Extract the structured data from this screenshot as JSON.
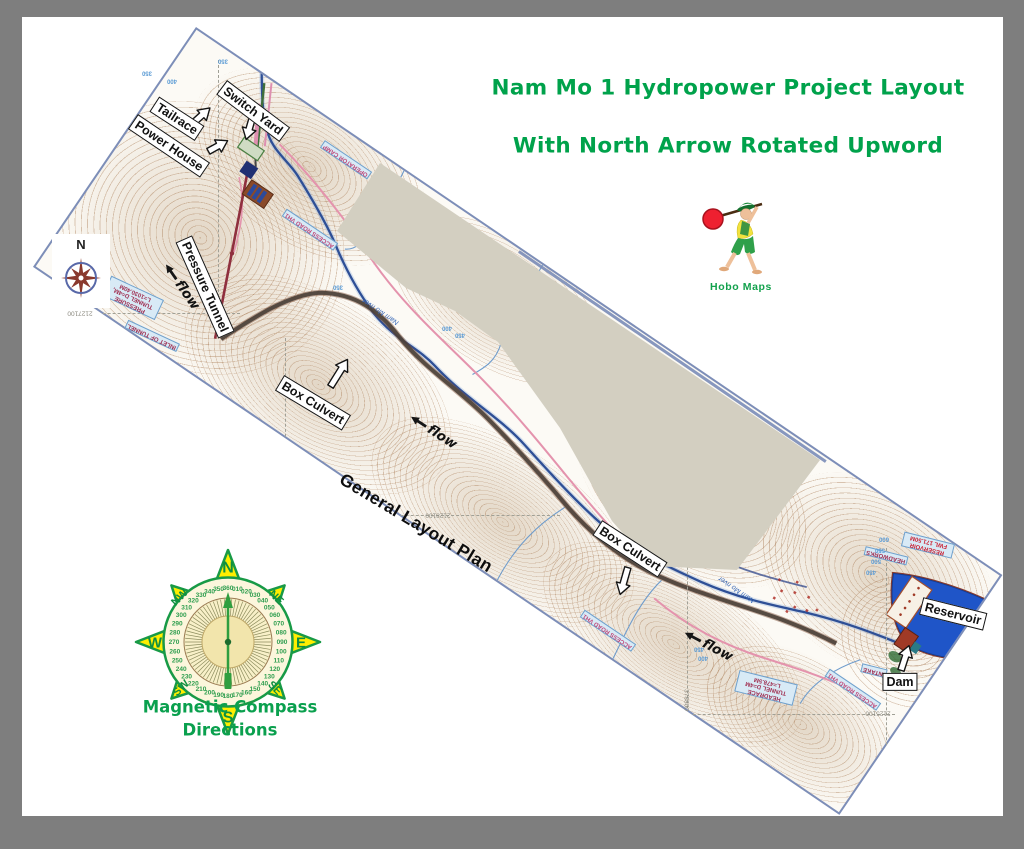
{
  "title": {
    "line1": "Nam Mo 1 Hydropower Project Layout",
    "line2": "With North Arrow Rotated Upword",
    "color": "#00a24b"
  },
  "logo": {
    "label": "Hobo Maps"
  },
  "plan_label": "General Layout Plan",
  "north_box": {
    "label": "N"
  },
  "compass": {
    "caption_line1": "Magnetic Compass",
    "caption_line2": "Directions",
    "degree_step": 10,
    "degree_count": 36,
    "tick_count": 72,
    "directions": [
      {
        "label": "N",
        "deg": 0,
        "r": 75,
        "size": 16,
        "rot": 0
      },
      {
        "label": "NE",
        "deg": 45,
        "r": 65,
        "size": 11,
        "rot": 45
      },
      {
        "label": "E",
        "deg": 90,
        "r": 73,
        "size": 15,
        "rot": 0
      },
      {
        "label": "SE",
        "deg": 135,
        "r": 63,
        "size": 11,
        "rot": 45
      },
      {
        "label": "S",
        "deg": 180,
        "r": 75,
        "size": 16,
        "rot": 0
      },
      {
        "label": "SW",
        "deg": 225,
        "r": 63,
        "size": 11,
        "rot": -45
      },
      {
        "label": "W",
        "deg": 270,
        "r": 73,
        "size": 15,
        "rot": 0
      },
      {
        "label": "NW",
        "deg": 315,
        "r": 65,
        "size": 11,
        "rot": -45
      }
    ],
    "colors": {
      "star": "#ffee00",
      "outline": "#189a46",
      "numbers": "#2f9e4f",
      "needle": "#2f9e3f",
      "face": "#fcf6dc",
      "inner": "#f2e5ac"
    }
  },
  "callouts": [
    {
      "label": "Switch Yard",
      "x": 253,
      "y": 111,
      "rot": 37
    },
    {
      "label": "Tailrace",
      "x": 177,
      "y": 119,
      "rot": 33
    },
    {
      "label": "Power House",
      "x": 169,
      "y": 146,
      "rot": 34
    },
    {
      "label": "Pressure Tunnel",
      "x": 205,
      "y": 287,
      "rot": 66
    },
    {
      "label": "Box Culvert",
      "x": 313,
      "y": 403,
      "rot": 31
    },
    {
      "label": "Box Culvert",
      "x": 630,
      "y": 549,
      "rot": 33
    },
    {
      "label": "Reservoir",
      "x": 953,
      "y": 614,
      "rot": 14
    },
    {
      "label": "Dam",
      "x": 900,
      "y": 682,
      "rot": 0
    }
  ],
  "flow_labels": [
    {
      "label": "flow",
      "x": 181,
      "y": 286,
      "rot": 55
    },
    {
      "label": "flow",
      "x": 433,
      "y": 431,
      "rot": 33
    },
    {
      "label": "flow",
      "x": 708,
      "y": 645,
      "rot": 28
    }
  ],
  "callout_arrows": [
    {
      "x": 201,
      "y": 116,
      "rot": 48,
      "len": 26
    },
    {
      "x": 218,
      "y": 146,
      "rot": 61,
      "len": 24
    },
    {
      "x": 250,
      "y": 126,
      "rot": 196,
      "len": 30
    },
    {
      "x": 339,
      "y": 373,
      "rot": 32,
      "len": 34
    },
    {
      "x": 624,
      "y": 581,
      "rot": 196,
      "len": 30
    },
    {
      "x": 905,
      "y": 658,
      "rot": 18,
      "len": 28
    }
  ],
  "map_texts": [
    {
      "text": "OPERATOR CAMP",
      "x": 346,
      "y": 160,
      "rot": 214,
      "cls": "mt-road"
    },
    {
      "text": "ACCESS ROAD VH1",
      "x": 310,
      "y": 230,
      "rot": 214,
      "cls": "mt-road"
    },
    {
      "text": "ACCESS ROAD VH1",
      "x": 608,
      "y": 631,
      "rot": 214,
      "cls": "mt-road"
    },
    {
      "text": "ACCESS ROAD VH1",
      "x": 853,
      "y": 690,
      "rot": 214,
      "cls": "mt-road"
    },
    {
      "text": "PRESSURE TUNNEL D=4M, L=1030.40M",
      "x": 133,
      "y": 298,
      "rot": 205,
      "cls": "mt-eng",
      "w": 54
    },
    {
      "text": "INLET OF TUNNEL",
      "x": 152,
      "y": 336,
      "rot": 205,
      "cls": "mt-eng"
    },
    {
      "text": "HEADRACE TUNNEL D=4M L=478.5M",
      "x": 766,
      "y": 688,
      "rot": 194,
      "cls": "mt-eng",
      "w": 56
    },
    {
      "text": "HEADWORKS",
      "x": 886,
      "y": 556,
      "rot": 194,
      "cls": "mt-eng"
    },
    {
      "text": "INTAKE",
      "x": 874,
      "y": 671,
      "rot": 194,
      "cls": "mt-eng"
    },
    {
      "text": "RESERVOIR FWL 171.50M",
      "x": 928,
      "y": 545,
      "rot": 194,
      "cls": "mt-res",
      "w": 48
    },
    {
      "text": "Nam Mo river",
      "x": 381,
      "y": 311,
      "rot": 214,
      "cls": "mt-river"
    },
    {
      "text": "Nam Mo river",
      "x": 737,
      "y": 589,
      "rot": 214,
      "cls": "mt-river"
    },
    {
      "text": "2127100",
      "x": 80,
      "y": 313,
      "rot": 180,
      "cls": "mt-grid"
    },
    {
      "text": "2128100",
      "x": 438,
      "y": 515,
      "rot": 180,
      "cls": "mt-grid"
    },
    {
      "text": "2125100",
      "x": 878,
      "y": 713,
      "rot": 180,
      "cls": "mt-grid"
    },
    {
      "text": "378800",
      "x": 686,
      "y": 700,
      "rot": 90,
      "cls": "mt-grid"
    },
    {
      "text": "350",
      "x": 147,
      "y": 72,
      "rot": 180,
      "cls": "mt-elev"
    },
    {
      "text": "400",
      "x": 172,
      "y": 80,
      "rot": 180,
      "cls": "mt-elev"
    },
    {
      "text": "350",
      "x": 223,
      "y": 60,
      "rot": 180,
      "cls": "mt-elev"
    },
    {
      "text": "350",
      "x": 338,
      "y": 286,
      "rot": 180,
      "cls": "mt-elev"
    },
    {
      "text": "400",
      "x": 447,
      "y": 327,
      "rot": 180,
      "cls": "mt-elev"
    },
    {
      "text": "450",
      "x": 460,
      "y": 334,
      "rot": 180,
      "cls": "mt-elev"
    },
    {
      "text": "600",
      "x": 884,
      "y": 538,
      "rot": 180,
      "cls": "mt-elev"
    },
    {
      "text": "550",
      "x": 880,
      "y": 549,
      "rot": 180,
      "cls": "mt-elev"
    },
    {
      "text": "500",
      "x": 876,
      "y": 560,
      "rot": 180,
      "cls": "mt-elev"
    },
    {
      "text": "450",
      "x": 871,
      "y": 571,
      "rot": 180,
      "cls": "mt-elev"
    },
    {
      "text": "400",
      "x": 703,
      "y": 657,
      "rot": 180,
      "cls": "mt-elev"
    },
    {
      "text": "450",
      "x": 699,
      "y": 648,
      "rot": 180,
      "cls": "mt-elev"
    }
  ]
}
